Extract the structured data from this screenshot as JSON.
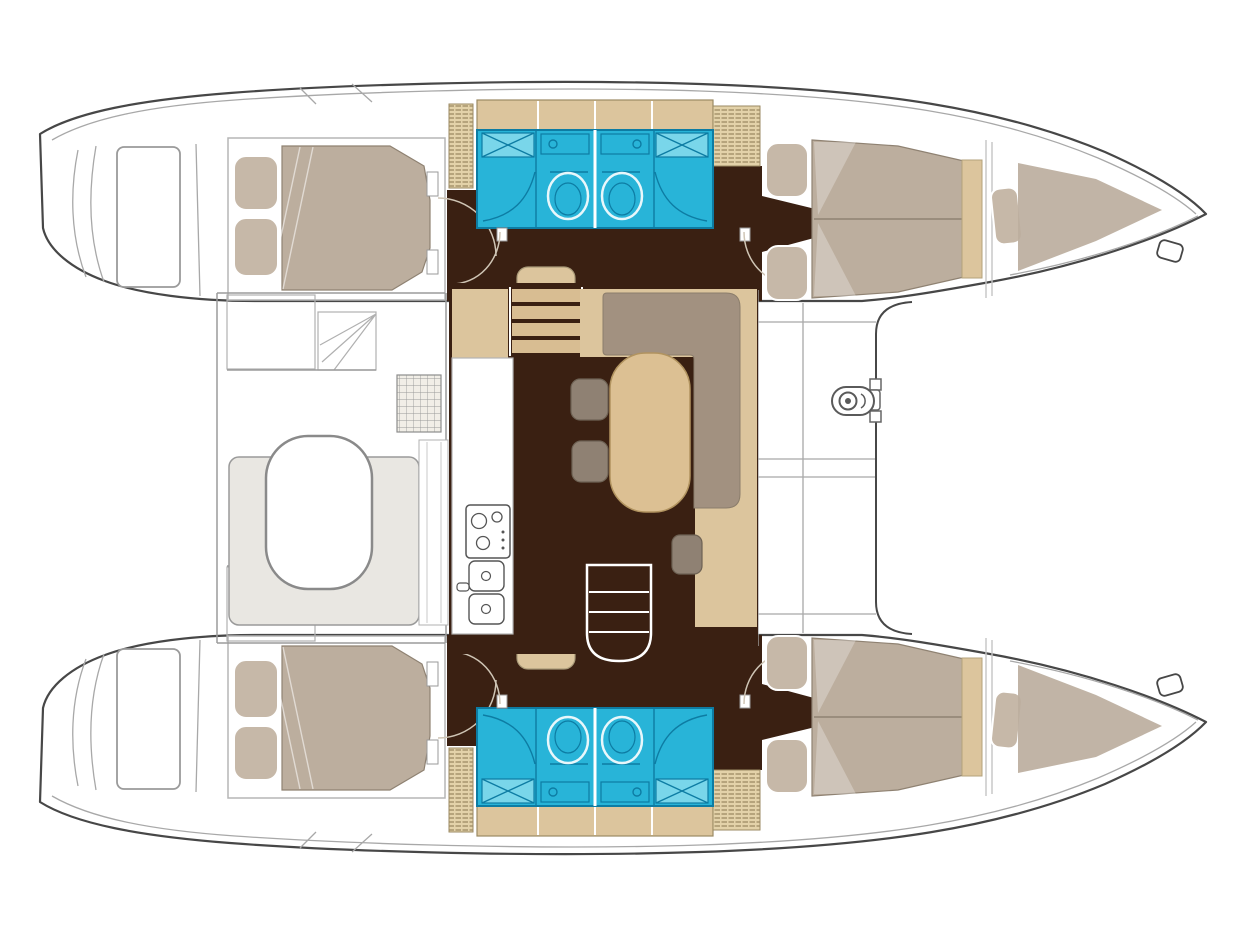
{
  "document": {
    "type": "boat-floor-plan",
    "vessel": "sailing catamaran interior layout",
    "view": "top-down deck plan, bows to the right, sterns to the left"
  },
  "colors": {
    "line": "#474747",
    "line-light": "#a8a8a8",
    "floor-dark": "#3a2012",
    "floor-tan": "#dcc59d",
    "tread": "#d8bd92",
    "mattress": "#bcae9e",
    "pillow": "#c6b8a8",
    "sofa": "#a29180",
    "stool": "#8f8173",
    "table": "#dcc093",
    "bath": "#28b4d8",
    "bath-dark": "#0d7ca3",
    "bath-light": "#79d6ea",
    "bench": "#e9e7e2",
    "hatch-bg": "#e3d2a9",
    "hatch-line": "#8a774f",
    "grate-bg": "#f1eee7"
  },
  "features": {
    "hulls": 2,
    "double_cabins": 4,
    "bow_berths": 2,
    "bathrooms": 4,
    "toilets": 4,
    "shower_pans": 4,
    "salon_dining_tables": 1,
    "salon_sofas": 1,
    "salon_stools": 3,
    "galley_stoves": 1,
    "galley_sinks": 2,
    "cockpit_tables": 1,
    "cockpit_benches": 1,
    "deck_shower_grates": 2,
    "stair_flights": 2,
    "windlasses": 1,
    "bow_cleats": 2,
    "hatched_storage_lockers": 4,
    "transom_swim_steps": 2
  }
}
